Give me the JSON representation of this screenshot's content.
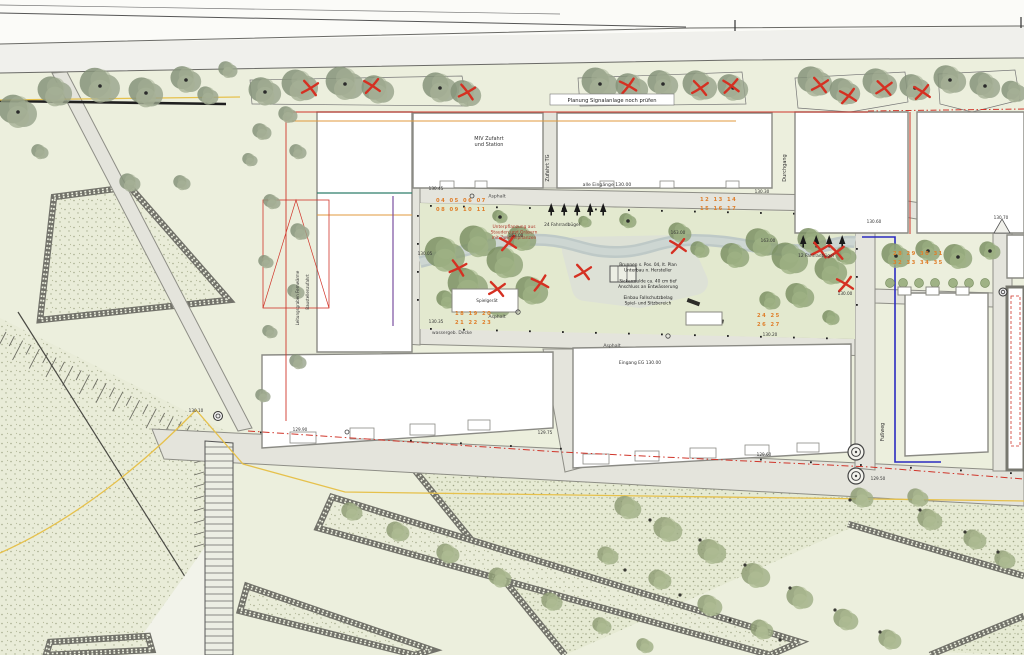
{
  "plan": {
    "type": "landscape-site-plan",
    "colors": {
      "background": "#ecefdd",
      "road": "#f0f0ec",
      "path": "#e4e4dc",
      "courtyard": "#e3e9cf",
      "building": "#ffffff",
      "building_stroke": "#8a8a84",
      "stipple_dot": "#a8ae90",
      "crenellation": "#72726a",
      "tree_street": "#97a28b",
      "tree_court": "#8da175",
      "shrub": "#9fae85",
      "removal_mark": "#d53022",
      "boundary_red": "#d0352a",
      "boundary_blue": "#2b2bc0",
      "utility_yellow": "#e6c14c",
      "utility_orange": "#e09a3c",
      "utility_purple": "#7a4fa0",
      "utility_teal": "#2e7d6a",
      "parking_number": "#df7e2a"
    },
    "labels": [
      {
        "t": "Planung Signalanlage noch prüfen",
        "x": 612,
        "y": 102,
        "s": 5.2,
        "c": "#222",
        "box": [
          550,
          94,
          124,
          11
        ]
      },
      {
        "t": "MIV Zufahrt|und Station",
        "x": 489,
        "y": 140,
        "s": 5,
        "c": "#333"
      },
      {
        "t": "Zufahrt TG",
        "x": 549,
        "y": 168,
        "s": 5,
        "c": "#333",
        "rot": -90
      },
      {
        "t": "Durchgang",
        "x": 786,
        "y": 168,
        "s": 5,
        "c": "#333",
        "rot": -90
      },
      {
        "t": "alle Eingänge 130.00",
        "x": 607,
        "y": 186,
        "s": 4.6,
        "c": "#333"
      },
      {
        "t": "Asphalt",
        "x": 497,
        "y": 197.5,
        "s": 4.6,
        "c": "#444"
      },
      {
        "t": "Asphalt",
        "x": 497,
        "y": 318,
        "s": 4.6,
        "c": "#444"
      },
      {
        "t": "Asphalt",
        "x": 612,
        "y": 347,
        "s": 4.6,
        "c": "#444"
      },
      {
        "t": "wassergeb. Decke",
        "x": 452,
        "y": 334,
        "s": 4.4,
        "c": "#444"
      },
      {
        "t": "24 Fahrradbügel",
        "x": 562,
        "y": 226,
        "s": 4.4,
        "c": "#333"
      },
      {
        "t": "12 Fahrradbügel",
        "x": 816,
        "y": 257,
        "s": 4.4,
        "c": "#333"
      },
      {
        "t": "Unterpflanzung aus|Stauden und Gräsern|mit Zwiebelpflanzen",
        "x": 514,
        "y": 228,
        "s": 4.4,
        "c": "#b03a2e"
      },
      {
        "t": "Brunnen s. Pos. 04, lt. Plan|Unterbau n. Hersteller||Sickermulde ca. 40 cm tief|Anschluss an Entwässerung||Einbau Fallschutzbelag|Spiel- und Sitzbereich",
        "x": 648,
        "y": 266,
        "s": 4.3,
        "c": "#222"
      },
      {
        "t": "Fußweg",
        "x": 884,
        "y": 432,
        "s": 4.8,
        "c": "#333",
        "rot": -90
      },
      {
        "t": "Leitungsgraben Fernwärme",
        "x": 299,
        "y": 298,
        "s": 4,
        "c": "#333",
        "rot": -90
      },
      {
        "t": "Baustellenzufahrt",
        "x": 309,
        "y": 292,
        "s": 4,
        "c": "#333",
        "rot": -90
      },
      {
        "t": "Eingang EG 130.00",
        "x": 640,
        "y": 364,
        "s": 4.4,
        "c": "#333"
      },
      {
        "t": "Spielgerät",
        "x": 487,
        "y": 302,
        "s": 4.2,
        "c": "#333"
      }
    ],
    "elevations": [
      [
        436,
        190,
        "130.45"
      ],
      [
        762,
        193,
        "130.30"
      ],
      [
        516,
        237,
        "163.00"
      ],
      [
        678,
        234,
        "163.00"
      ],
      [
        768,
        242,
        "163.00"
      ],
      [
        436,
        323,
        "130.35"
      ],
      [
        770,
        336,
        "130.20"
      ],
      [
        545,
        434,
        "129.75"
      ],
      [
        764,
        456,
        "129.60"
      ],
      [
        878,
        480,
        "129.50"
      ],
      [
        874,
        223,
        "130.60"
      ],
      [
        1001,
        219,
        "130.70"
      ],
      [
        300,
        431,
        "129.90"
      ],
      [
        196,
        412,
        "130.10"
      ],
      [
        845,
        295,
        "130.00"
      ],
      [
        425,
        255,
        "130.05"
      ]
    ],
    "parking_rows": [
      [
        436,
        202,
        "04 05 06 07"
      ],
      [
        436,
        211,
        "08 09 10 11"
      ],
      [
        700,
        201,
        "12 13 14"
      ],
      [
        700,
        210,
        "15 16 17"
      ],
      [
        455,
        315,
        "18 19 20"
      ],
      [
        455,
        324,
        "21 22 23"
      ],
      [
        757,
        317,
        "24 25"
      ],
      [
        757,
        326,
        "26 27"
      ],
      [
        893,
        255,
        "28 29 30 31"
      ],
      [
        893,
        264,
        "32 33 34 35"
      ]
    ],
    "trees": {
      "street": [
        [
          265,
          92,
          17
        ],
        [
          300,
          86,
          19
        ],
        [
          345,
          84,
          20
        ],
        [
          378,
          90,
          17
        ],
        [
          440,
          88,
          18
        ],
        [
          466,
          94,
          16
        ],
        [
          600,
          84,
          19
        ],
        [
          632,
          88,
          17
        ],
        [
          663,
          84,
          16
        ],
        [
          700,
          86,
          18
        ],
        [
          733,
          88,
          16
        ],
        [
          815,
          82,
          18
        ],
        [
          845,
          92,
          16
        ],
        [
          880,
          84,
          18
        ],
        [
          915,
          88,
          16
        ],
        [
          950,
          80,
          17
        ],
        [
          985,
          86,
          16
        ],
        [
          1014,
          92,
          13
        ]
      ],
      "left": [
        [
          18,
          112,
          20
        ],
        [
          55,
          92,
          18
        ],
        [
          100,
          86,
          21
        ],
        [
          146,
          93,
          18
        ],
        [
          186,
          80,
          16
        ],
        [
          208,
          96,
          11
        ],
        [
          228,
          70,
          10
        ],
        [
          40,
          152,
          9
        ],
        [
          130,
          183,
          11
        ],
        [
          182,
          183,
          9
        ],
        [
          262,
          132,
          10
        ],
        [
          298,
          152,
          9
        ],
        [
          272,
          202,
          9
        ],
        [
          300,
          232,
          10
        ],
        [
          266,
          262,
          8
        ],
        [
          296,
          292,
          9
        ],
        [
          270,
          332,
          8
        ],
        [
          298,
          362,
          9
        ],
        [
          263,
          396,
          8
        ],
        [
          250,
          160,
          8
        ],
        [
          288,
          115,
          10
        ]
      ],
      "court": [
        [
          445,
          255,
          21
        ],
        [
          478,
          242,
          19
        ],
        [
          468,
          286,
          21
        ],
        [
          505,
          263,
          19
        ],
        [
          522,
          239,
          15
        ],
        [
          532,
          291,
          17
        ],
        [
          498,
          307,
          13
        ],
        [
          447,
          300,
          11
        ],
        [
          500,
          217,
          8
        ],
        [
          628,
          221,
          9
        ],
        [
          680,
          233,
          12
        ],
        [
          700,
          250,
          10
        ],
        [
          735,
          256,
          15
        ],
        [
          762,
          243,
          17
        ],
        [
          790,
          259,
          19
        ],
        [
          812,
          241,
          15
        ],
        [
          831,
          271,
          17
        ],
        [
          800,
          296,
          15
        ],
        [
          770,
          301,
          11
        ],
        [
          846,
          256,
          11
        ],
        [
          831,
          318,
          9
        ],
        [
          585,
          222,
          7
        ]
      ],
      "park_right": [
        [
          896,
          256,
          15
        ],
        [
          928,
          251,
          13
        ],
        [
          958,
          257,
          15
        ],
        [
          990,
          251,
          11
        ]
      ],
      "bed3_shrubs": [
        [
          352,
          512,
          11
        ],
        [
          398,
          532,
          12
        ],
        [
          448,
          554,
          12
        ],
        [
          500,
          578,
          12
        ],
        [
          552,
          602,
          11
        ],
        [
          602,
          626,
          10
        ],
        [
          645,
          646,
          9
        ]
      ],
      "bed4_shrubs": [
        [
          628,
          508,
          14
        ],
        [
          668,
          530,
          15
        ],
        [
          712,
          552,
          15
        ],
        [
          756,
          576,
          15
        ],
        [
          800,
          598,
          14
        ],
        [
          846,
          620,
          13
        ],
        [
          890,
          640,
          12
        ],
        [
          660,
          580,
          12
        ],
        [
          710,
          606,
          13
        ],
        [
          762,
          630,
          12
        ],
        [
          608,
          556,
          11
        ],
        [
          930,
          520,
          13
        ],
        [
          975,
          540,
          12
        ],
        [
          1005,
          560,
          11
        ],
        [
          918,
          498,
          11
        ],
        [
          862,
          498,
          12
        ]
      ],
      "shrub_row": [
        [
          890,
          283,
          4.5
        ],
        [
          903,
          283,
          4.5
        ],
        [
          919,
          283,
          4.5
        ],
        [
          935,
          283,
          4.5
        ],
        [
          953,
          283,
          4.5
        ],
        [
          969,
          283,
          4.5
        ],
        [
          985,
          283,
          4.5
        ]
      ]
    },
    "removal_marks": [
      [
        310,
        88,
        10
      ],
      [
        372,
        86,
        -8
      ],
      [
        467,
        92,
        12
      ],
      [
        628,
        86,
        -12
      ],
      [
        700,
        88,
        8
      ],
      [
        731,
        86,
        -6
      ],
      [
        820,
        85,
        10
      ],
      [
        848,
        96,
        -10
      ],
      [
        884,
        88,
        6
      ],
      [
        922,
        92,
        -8
      ],
      [
        458,
        268,
        15
      ],
      [
        508,
        243,
        -10
      ],
      [
        497,
        289,
        8
      ],
      [
        540,
        283,
        -14
      ],
      [
        583,
        272,
        10
      ],
      [
        678,
        246,
        -8
      ],
      [
        820,
        250,
        12
      ],
      [
        845,
        284,
        -10
      ],
      [
        836,
        252,
        6
      ]
    ],
    "existing_tree_dots": [
      [
        265,
        92
      ],
      [
        345,
        84
      ],
      [
        440,
        88
      ],
      [
        600,
        84
      ],
      [
        663,
        84
      ],
      [
        733,
        88
      ],
      [
        915,
        88
      ],
      [
        950,
        80
      ],
      [
        985,
        86
      ],
      [
        18,
        112
      ],
      [
        100,
        86
      ],
      [
        146,
        93
      ],
      [
        186,
        80
      ],
      [
        896,
        256
      ],
      [
        928,
        251
      ],
      [
        958,
        257
      ],
      [
        990,
        251
      ],
      [
        500,
        217
      ],
      [
        628,
        221
      ]
    ],
    "bed_dots": [
      [
        650,
        520
      ],
      [
        700,
        540
      ],
      [
        745,
        565
      ],
      [
        790,
        588
      ],
      [
        835,
        610
      ],
      [
        880,
        632
      ],
      [
        625,
        570
      ],
      [
        680,
        595
      ],
      [
        730,
        620
      ],
      [
        920,
        510
      ],
      [
        965,
        532
      ],
      [
        998,
        552
      ],
      [
        780,
        640
      ],
      [
        850,
        500
      ]
    ],
    "bike_racks": [
      {
        "x": 548,
        "y": 212,
        "n": 5,
        "dx": 13
      },
      {
        "x": 800,
        "y": 244,
        "n": 4,
        "dx": 13
      }
    ],
    "benches": {
      "table": [
        610,
        266,
        26,
        16
      ],
      "bars": [
        [
          688,
          298,
          13,
          4,
          20
        ],
        [
          714,
          318,
          10,
          4,
          10
        ],
        [
          452,
          296,
          11,
          4,
          -15
        ]
      ]
    },
    "stalls": [
      [
        898,
        287,
        13,
        8
      ],
      [
        926,
        287,
        13,
        8
      ],
      [
        956,
        287,
        13,
        8
      ],
      [
        686,
        312,
        36,
        13
      ],
      [
        452,
        289,
        66,
        23
      ]
    ],
    "facade_rects": [
      [
        290,
        432,
        26,
        11
      ],
      [
        350,
        428,
        24,
        11
      ],
      [
        410,
        424,
        25,
        11
      ],
      [
        468,
        420,
        22,
        10
      ],
      [
        583,
        454,
        26,
        10
      ],
      [
        635,
        451,
        24,
        10
      ],
      [
        690,
        448,
        26,
        10
      ],
      [
        745,
        445,
        24,
        10
      ],
      [
        797,
        443,
        22,
        9
      ],
      [
        440,
        181,
        14,
        7
      ],
      [
        475,
        181,
        12,
        7
      ],
      [
        600,
        181,
        14,
        7
      ],
      [
        660,
        181,
        14,
        7
      ],
      [
        726,
        181,
        13,
        7
      ]
    ],
    "double_circles": [
      [
        856,
        452,
        8
      ],
      [
        856,
        476,
        8
      ]
    ],
    "manholes": [
      [
        218,
        416,
        4.5
      ],
      [
        1003,
        292,
        4
      ]
    ],
    "small_circles": [
      [
        518,
        312,
        2.2
      ],
      [
        472,
        196,
        2
      ],
      [
        668,
        336,
        2.2
      ],
      [
        347,
        432,
        2
      ]
    ]
  }
}
